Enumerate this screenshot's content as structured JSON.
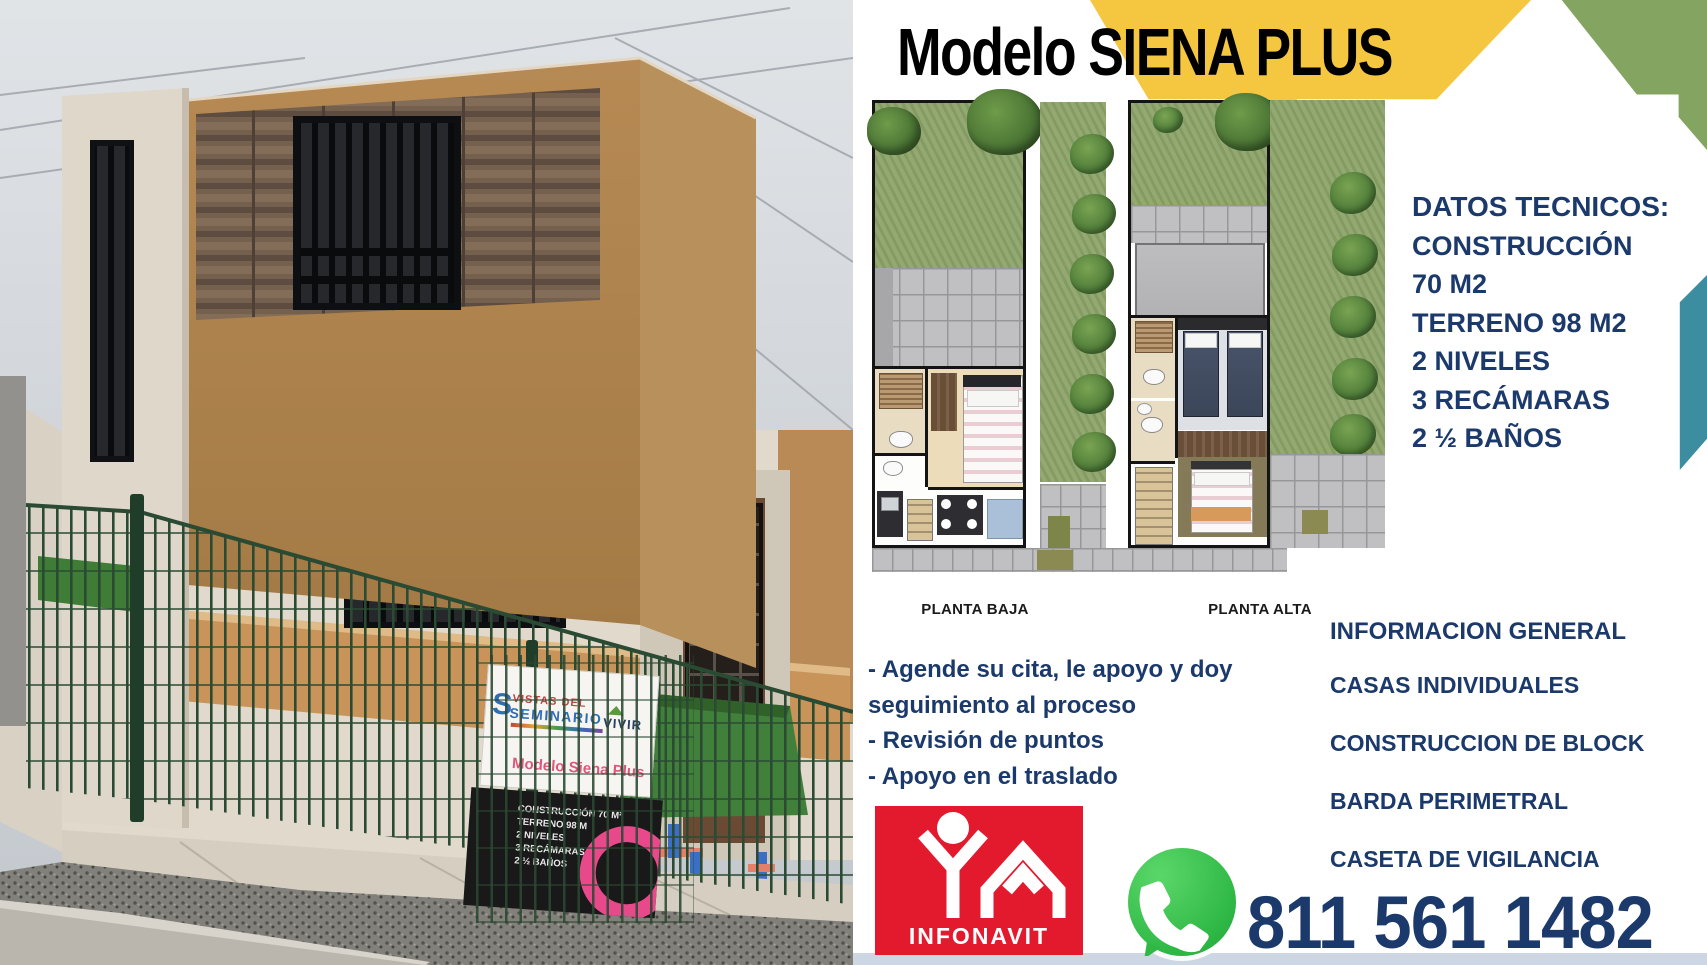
{
  "flyer": {
    "title": "Modelo SIENA PLUS",
    "floor_plans": {
      "left_label": "PLANTA BAJA",
      "right_label": "PLANTA ALTA"
    },
    "datos_tecnicos": {
      "heading": "DATOS TECNICOS:",
      "lines": [
        "CONSTRUCCIÓN",
        "70 M2",
        "TERRENO 98 M2",
        "2 NIVELES",
        "3 RECÁMARAS",
        "2 ½ BAÑOS"
      ]
    },
    "services": [
      "- Agende su cita, le apoyo y doy seguimiento al proceso",
      "- Revisión de puntos",
      "- Apoyo en el traslado"
    ],
    "informacion_general": {
      "heading": "INFORMACION GENERAL",
      "items": [
        "CASAS INDIVIDUALES",
        "CONSTRUCCION DE BLOCK",
        "BARDA PERIMETRAL",
        "CASETA DE VIGILANCIA"
      ]
    },
    "contact": {
      "phone": "811 561 1482",
      "whatsapp_icon": "whatsapp-icon",
      "infonavit_label": "INFONAVIT"
    },
    "photo_sign": {
      "brand_line1": "VISTAS DEL",
      "brand_line2": "SEMINARIO",
      "vivir": "VIVIR",
      "model_name": "Modelo Siena Plus",
      "specs": [
        "CONSTRUCCIÓN 70 M²",
        "TERRENO 98 M",
        "2 NIVELES",
        "3 RECÁMARAS",
        "2 ½ BAÑOS"
      ]
    },
    "colors": {
      "navy": "#1b3a6b",
      "accent_yellow": "#f5c63f",
      "accent_green": "#83a561",
      "accent_teal": "#3d8da1",
      "infonavit_red": "#e3192e",
      "whatsapp_green": "#2fb845"
    }
  }
}
